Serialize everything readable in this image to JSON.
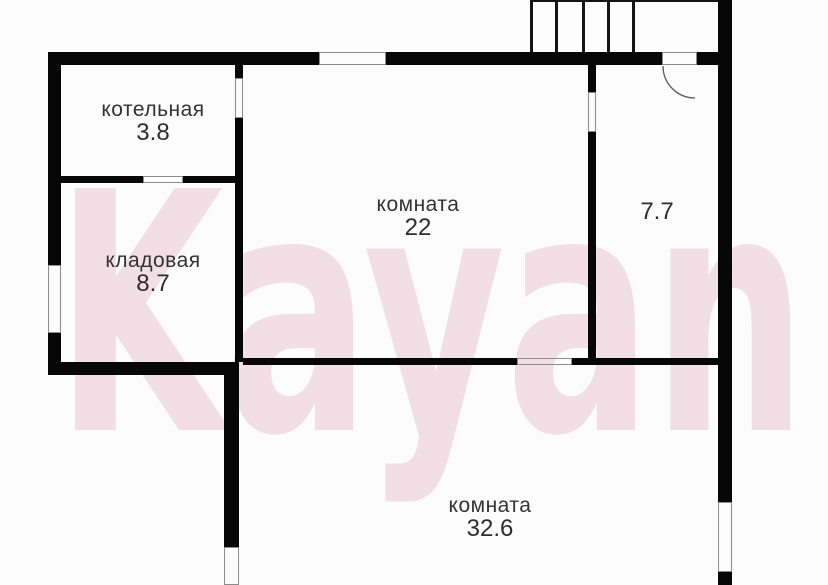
{
  "watermark": {
    "text": "Kayan",
    "color": "#cf6e8c"
  },
  "colors": {
    "wall": "#070707",
    "background": "#fcfcfc",
    "label": "#333333"
  },
  "rooms": [
    {
      "name": "котельная",
      "area": "3.8"
    },
    {
      "name": "кладовая",
      "area": "8.7"
    },
    {
      "name": "комната",
      "area": "22"
    },
    {
      "name": "",
      "area": "7.7"
    },
    {
      "name": "комната",
      "area": "32.6"
    }
  ]
}
